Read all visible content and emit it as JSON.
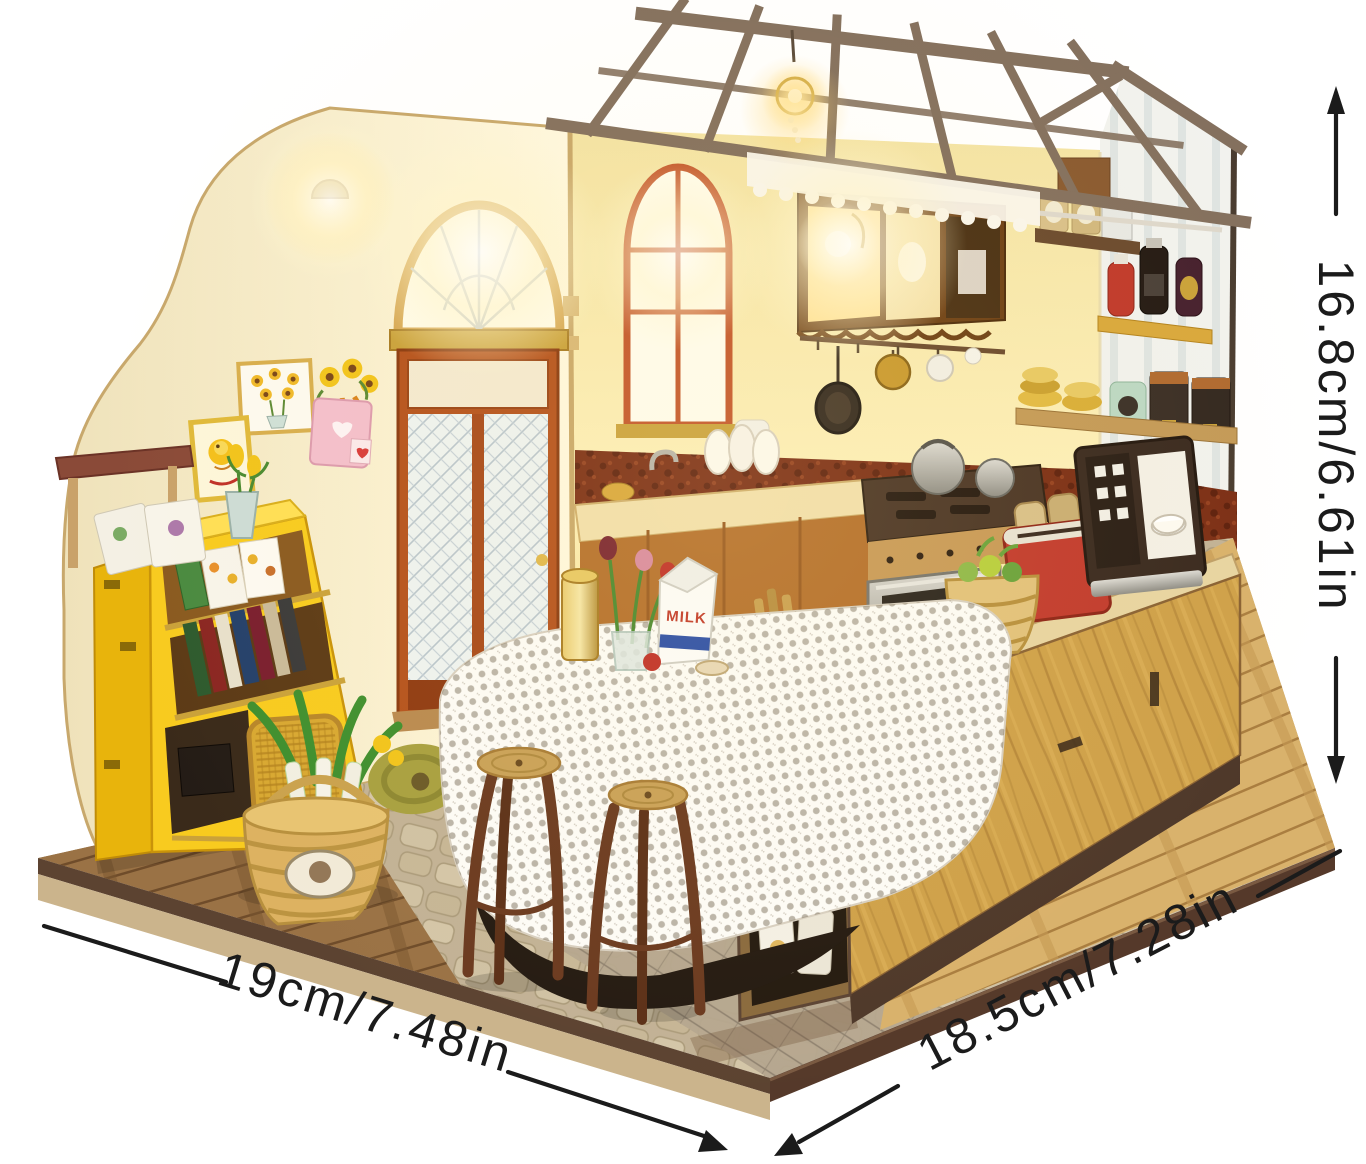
{
  "scene": {
    "subject": "DIY miniature dollhouse kitchen kit product photo",
    "background": "#ffffff"
  },
  "annotations": {
    "height_label": "16.8cm/6.61in",
    "width_label": "19cm/7.48in",
    "depth_label": "18.5cm/7.28in"
  },
  "product_text": {
    "milk_carton_label": "MILK"
  },
  "colors": {
    "background": "#ffffff",
    "annotation_line": "#1b1b1b",
    "roof_beam": "#84705e",
    "left_wall": "#f7eccb",
    "kitchen_wall": "#f9e9ad",
    "side_wall": "#f2f2ee",
    "door_frame": "#b5521d",
    "window_frame": "#c3562b",
    "gold_trim": "#d3a24b",
    "bookshelf_yellow": "#f8cb1f",
    "island_wood": "#cfa14a",
    "counter_wood": "#b5702c",
    "platform_dark": "#5c4331",
    "platform_light": "#cbb48c",
    "toaster_red": "#c23b2e",
    "milk_blue": "#2b4ea8",
    "glow": "#ffd978"
  }
}
